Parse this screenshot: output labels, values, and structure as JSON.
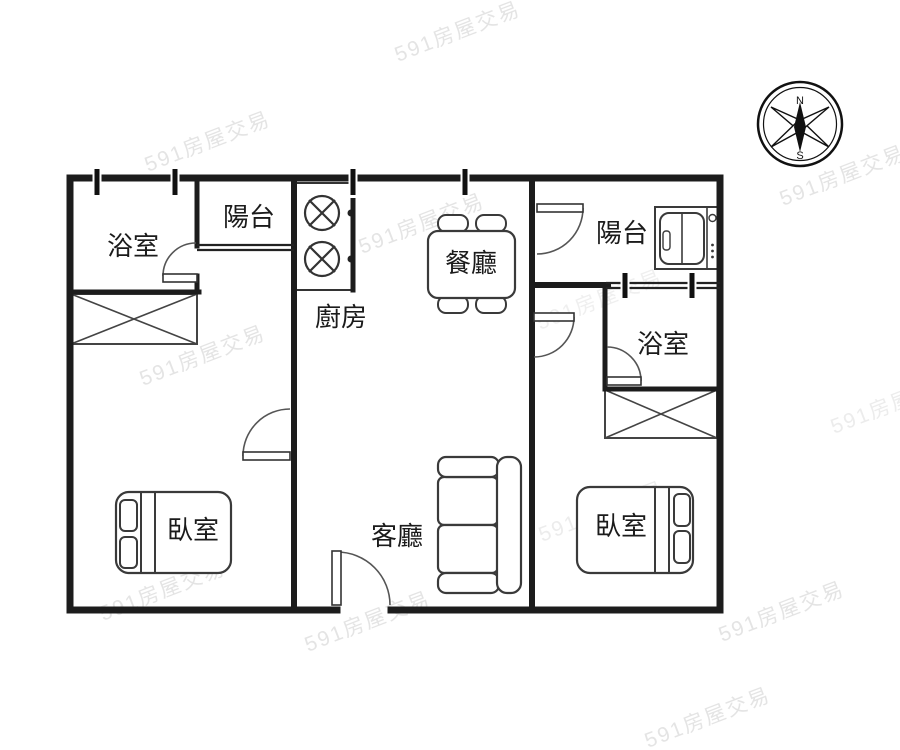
{
  "plan": {
    "watermark_text": "591房屋交易",
    "compass": {
      "north_label": "N",
      "south_label": "S"
    },
    "rooms": [
      {
        "id": "bathroom-left",
        "label": "浴室"
      },
      {
        "id": "balcony-left",
        "label": "陽台"
      },
      {
        "id": "kitchen",
        "label": "廚房"
      },
      {
        "id": "dining-room",
        "label": "餐廳"
      },
      {
        "id": "balcony-right",
        "label": "陽台"
      },
      {
        "id": "bathroom-right",
        "label": "浴室"
      },
      {
        "id": "bedroom-left",
        "label": "臥室"
      },
      {
        "id": "living-room",
        "label": "客廳"
      },
      {
        "id": "bedroom-right",
        "label": "臥室"
      }
    ],
    "icons": {
      "compass": "compass-rose-icon",
      "stove": "stove-burners-icon",
      "dining_table": "dining-table-icon",
      "sofa": "sofa-icon",
      "bed": "bed-icon",
      "washing_machine": "washing-machine-icon",
      "cabinet": "crossed-cabinet-icon",
      "door": "door-swing-icon",
      "window_tick": "window-tick-icon"
    },
    "colors": {
      "wall": "#1c1c1c",
      "furniture_line": "#3a3a3a",
      "label_text": "#1b1b1b",
      "watermark": "#e2e2e2",
      "background": "#ffffff"
    }
  }
}
